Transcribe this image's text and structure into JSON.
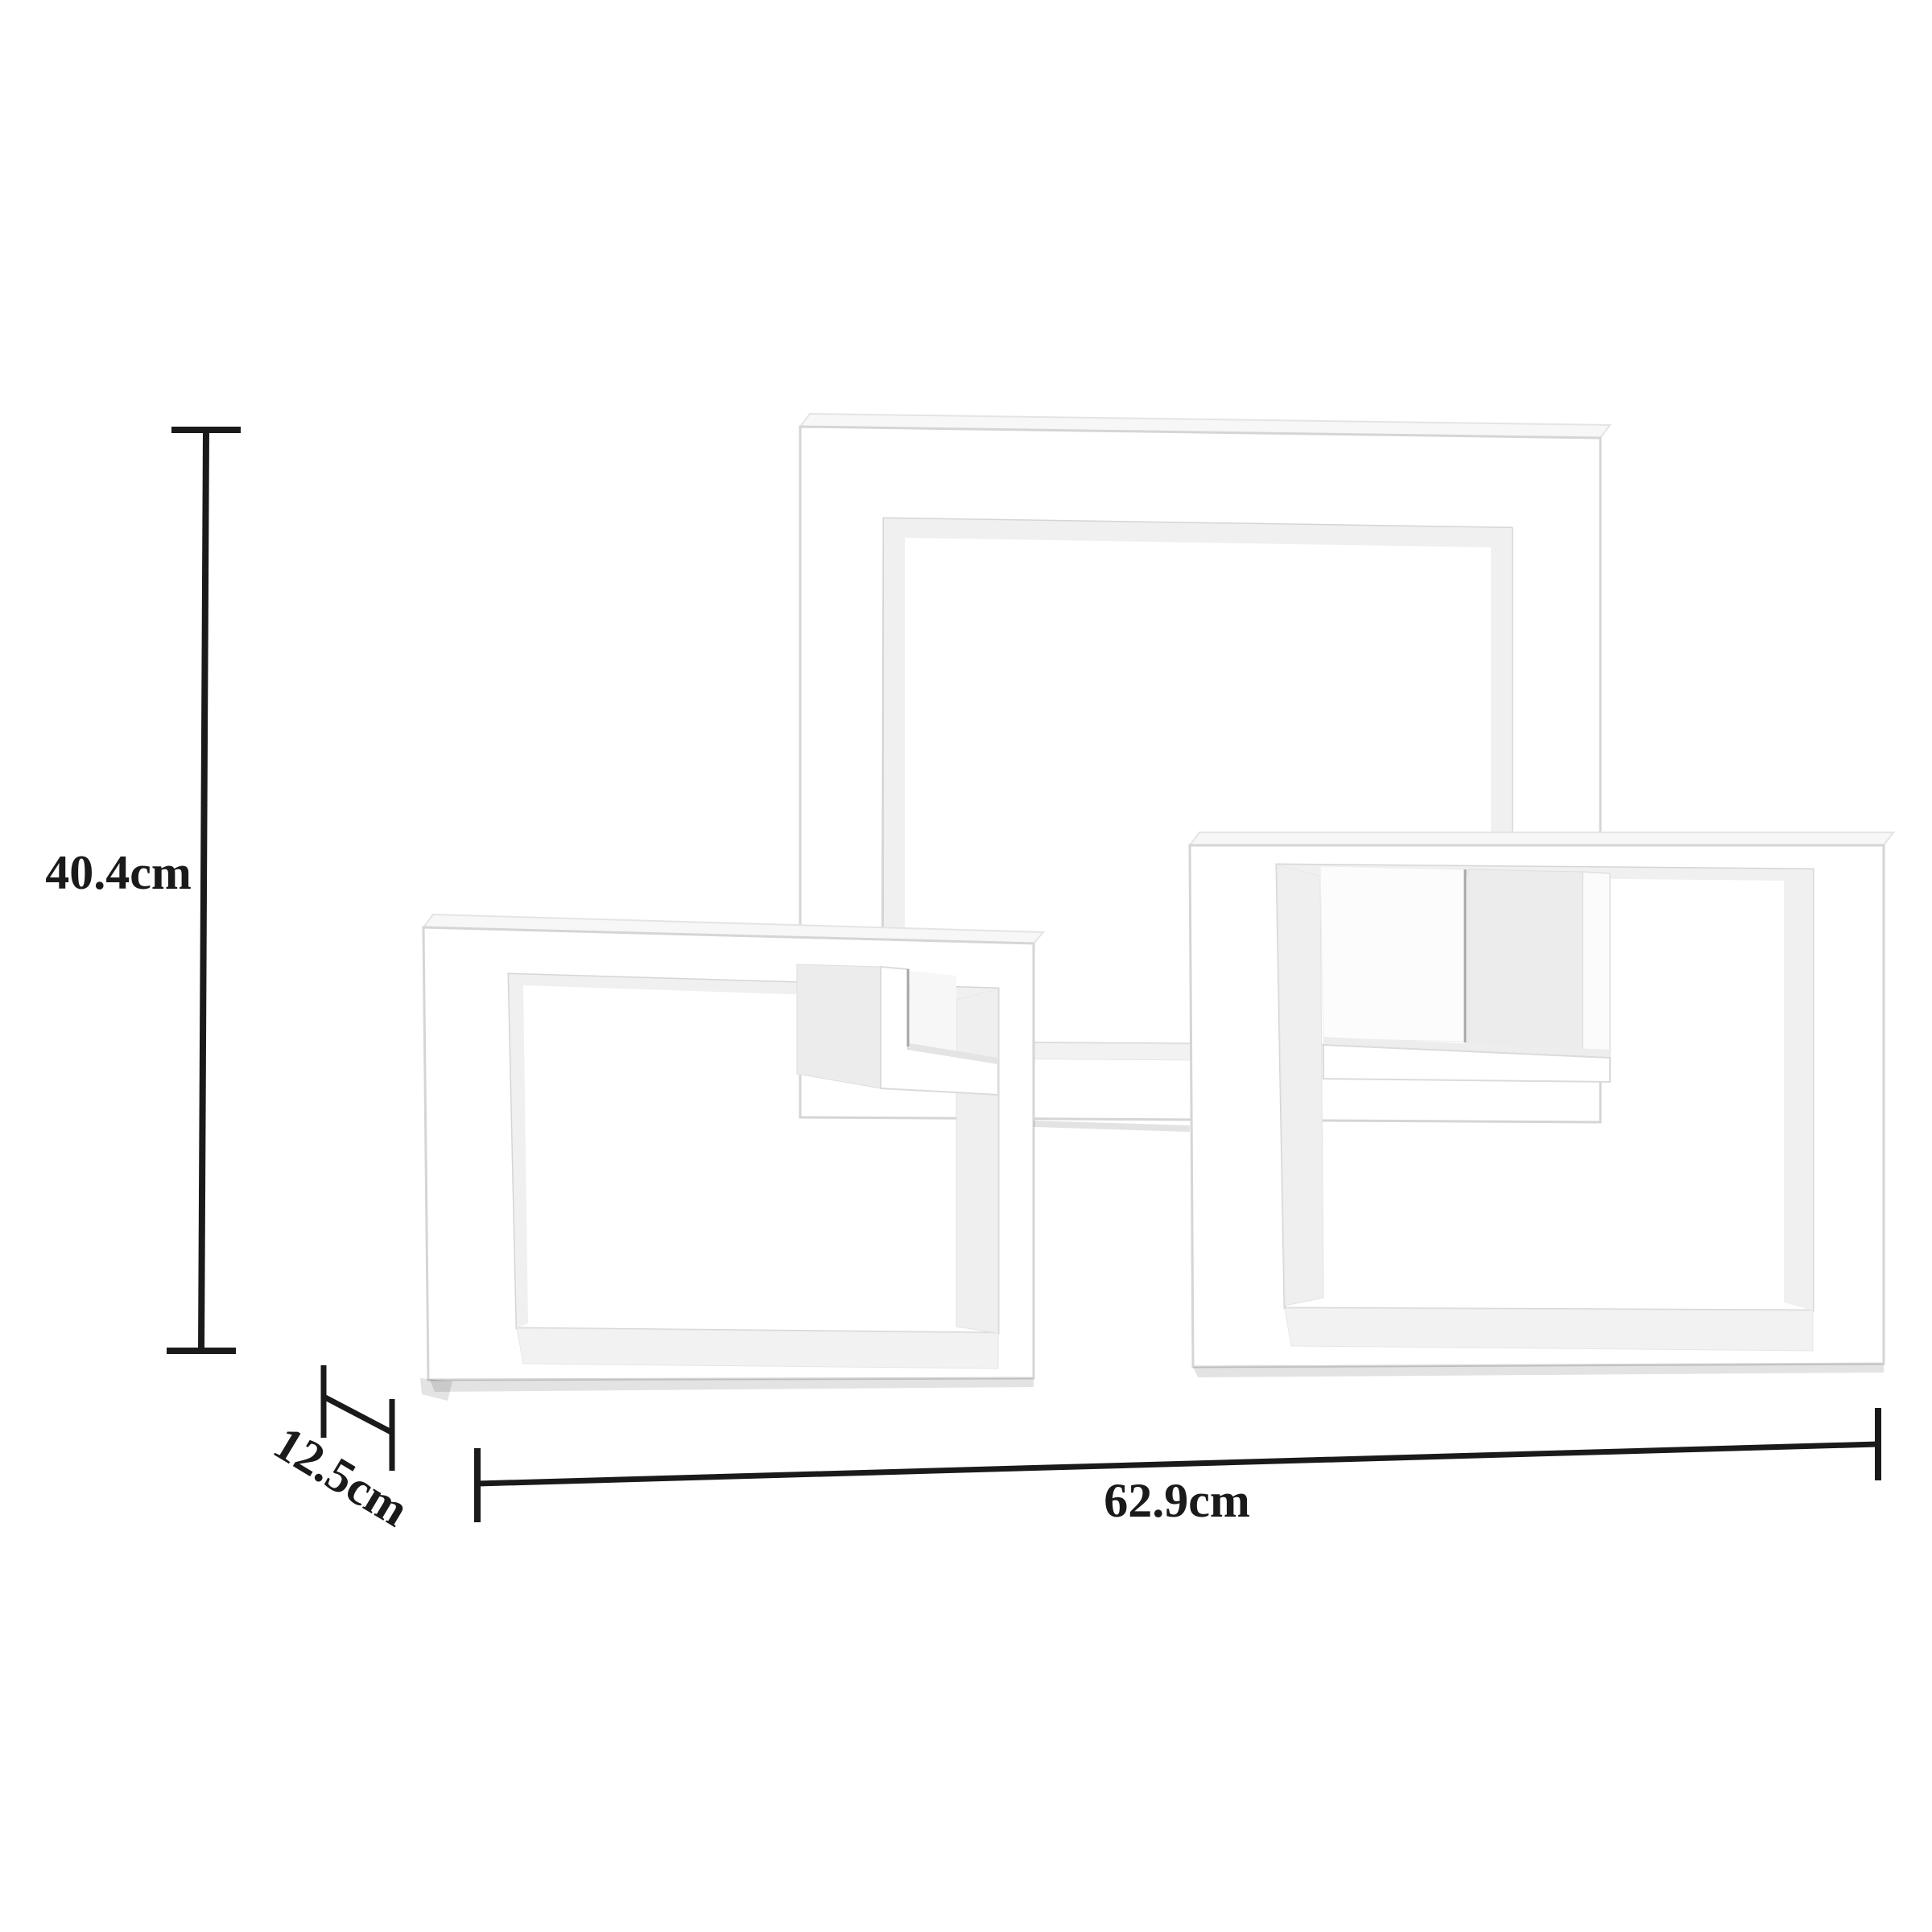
{
  "diagram": {
    "type": "product-dimension-diagram",
    "illustration": "three-interlocking-cube-wall-shelves",
    "background_color": "#ffffff",
    "shelf_color": "#ffffff",
    "shelf_shade_color": "#ececec",
    "shelf_edge_color": "#d5d5d5",
    "dimension_line_color": "#1a1a1a",
    "labels": {
      "height": "40.4cm",
      "depth": "12.5cm",
      "width": "62.9cm"
    }
  }
}
